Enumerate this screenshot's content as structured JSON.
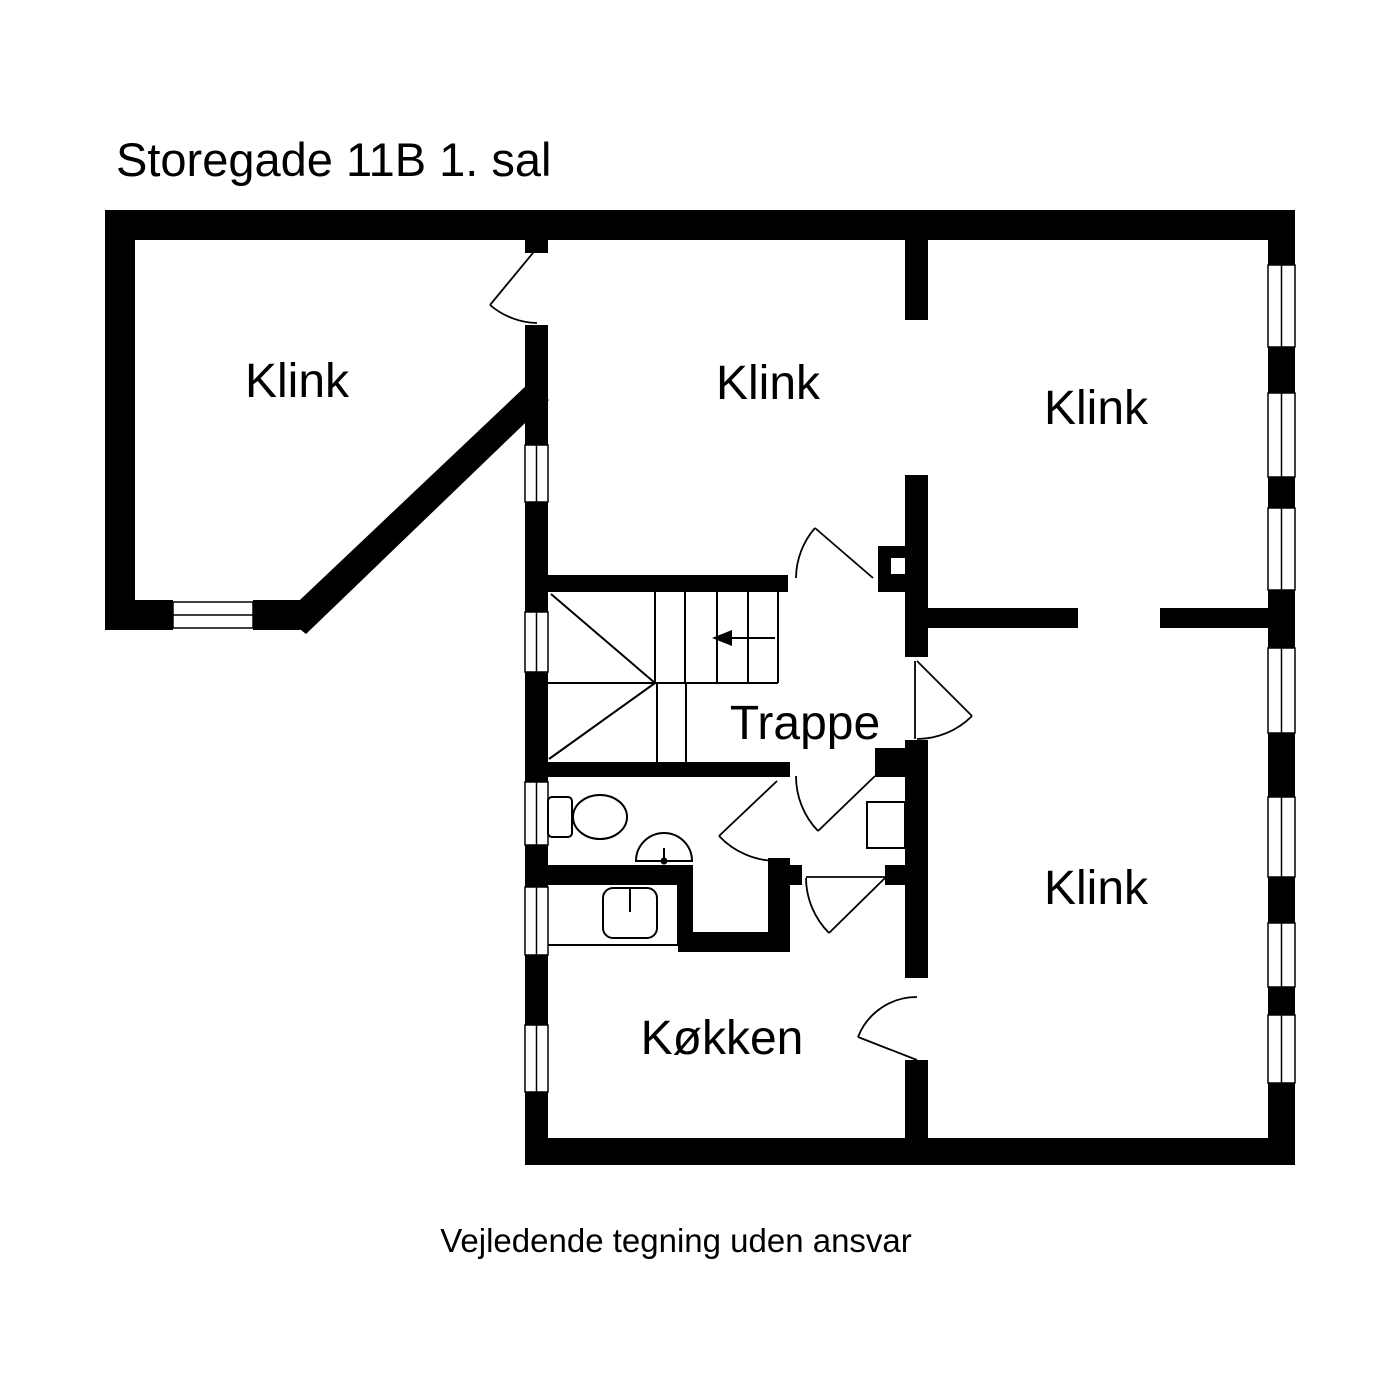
{
  "title": "Storegade 11B 1. sal",
  "footer": "Vejledende tegning uden ansvar",
  "rooms": [
    {
      "label": "Klink"
    },
    {
      "label": "Klink"
    },
    {
      "label": "Klink"
    },
    {
      "label": "Trappe"
    },
    {
      "label": "Klink"
    },
    {
      "label": "Køkken"
    }
  ],
  "fixtures": [
    "toilet-icon",
    "washbasin-icon",
    "kitchen-sink-icon",
    "stairs-icon",
    "stair-direction-arrow-icon",
    "hall-cabinet-icon"
  ],
  "colors": {
    "wall": "#000000",
    "background": "#ffffff",
    "text": "#000000"
  }
}
